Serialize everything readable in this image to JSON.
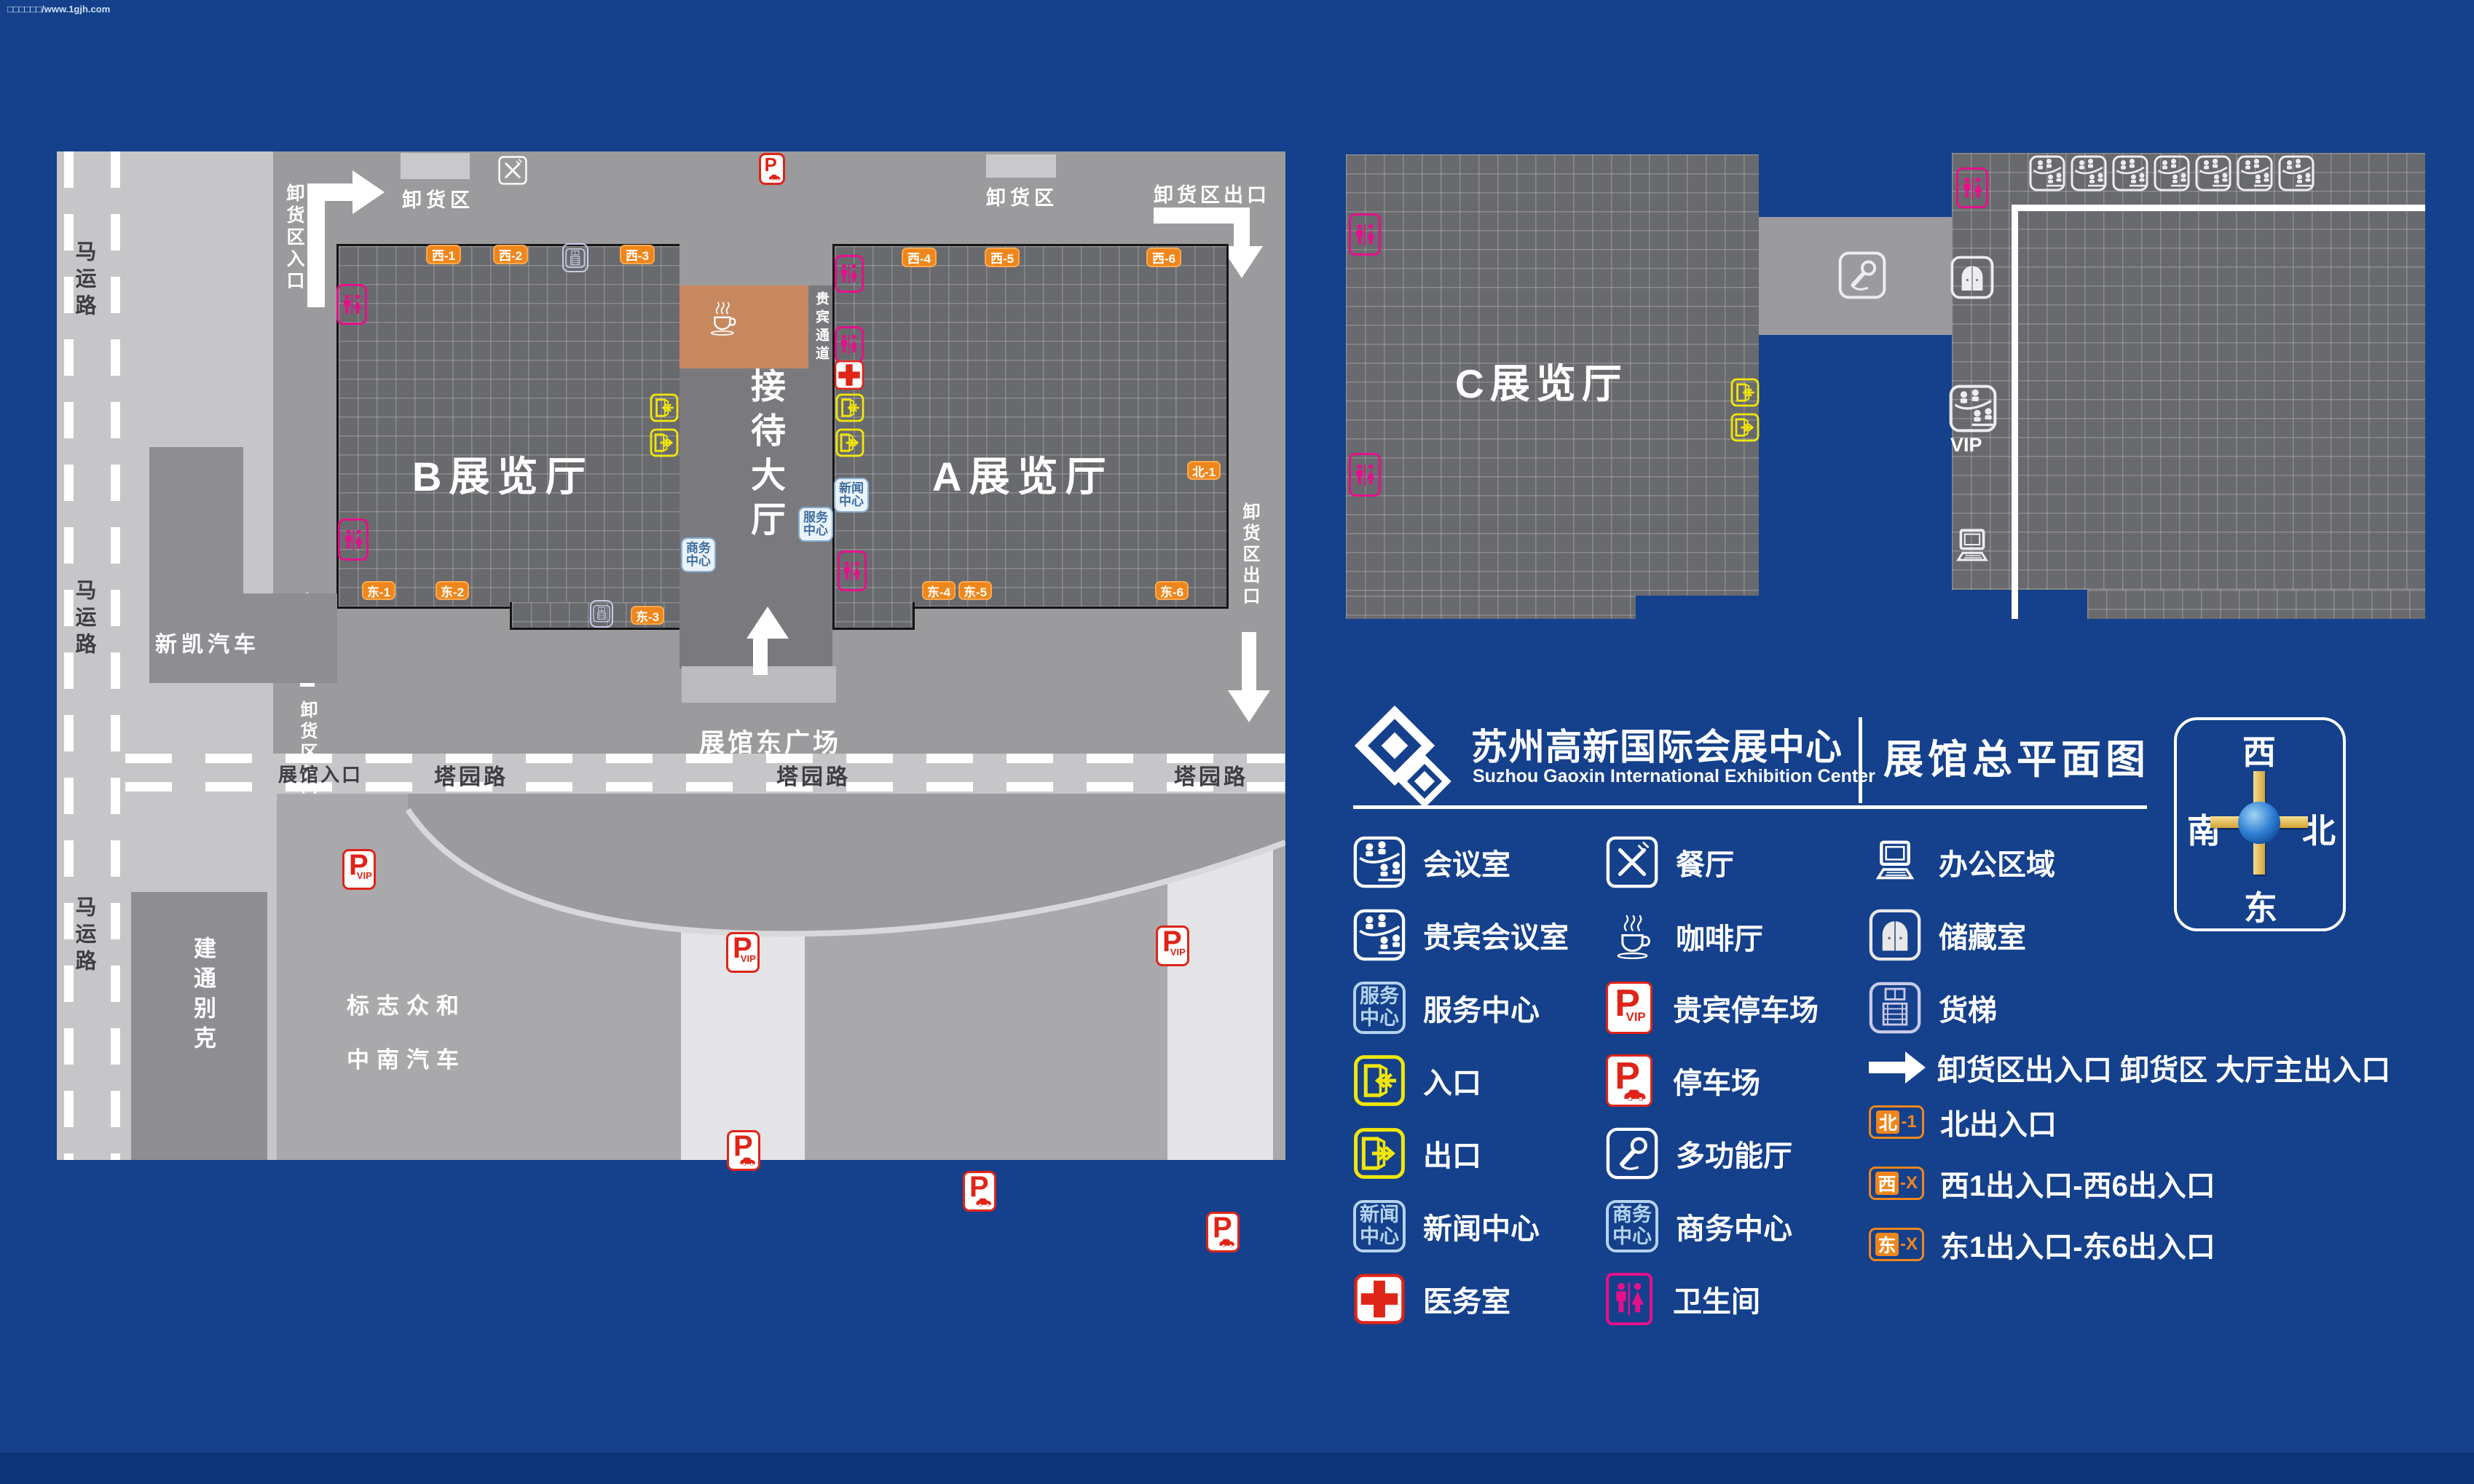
{
  "watermark": "□□□□□□/www.1gjh.com",
  "header": {
    "title_cn": "苏州高新国际会展中心",
    "title_en": "Suzhou Gaoxin International Exhibition Center",
    "map_title": "展馆总平面图"
  },
  "compass": {
    "west": "西",
    "south": "南",
    "north": "北",
    "east": "东"
  },
  "map": {
    "halls": {
      "a": "A展览厅",
      "b": "B展览厅",
      "c": "C展览厅"
    },
    "reception_hall": "接待大厅",
    "vip_passage": "贵宾通道",
    "east_plaza": "展馆东广场",
    "vip_label": "VIP",
    "roads": {
      "mayun": "马运路",
      "tayuan": "塔园路",
      "hall_entrance": "展馆入口"
    },
    "blocks": {
      "xinkai": "新凯汽车",
      "jiantong": "建通别克",
      "biaozhi": "标志众和",
      "zhongnan": "中南汽车"
    },
    "dock": {
      "area": "卸货区",
      "entrance": "卸货区入口",
      "exit": "卸货区出口"
    },
    "badges": {
      "west": [
        "西-1",
        "西-2",
        "西-3",
        "西-4",
        "西-5",
        "西-6"
      ],
      "east": [
        "东-1",
        "东-2",
        "东-3",
        "东-4",
        "东-5",
        "东-6"
      ],
      "north": "北-1"
    },
    "mini": {
      "news": "新闻中心",
      "service": "服务中心",
      "business": "商务中心"
    }
  },
  "icons": {
    "p": "P",
    "vip": "VIP"
  },
  "legend": {
    "col1": [
      {
        "icon": "conference-icon",
        "label": "会议室"
      },
      {
        "icon": "vip-conference-icon",
        "label": "贵宾会议室"
      },
      {
        "icon": "service-center-icon",
        "label": "服务中心"
      },
      {
        "icon": "entrance-icon",
        "label": "入口"
      },
      {
        "icon": "exit-icon",
        "label": "出口"
      },
      {
        "icon": "news-center-icon",
        "label": "新闻中心"
      },
      {
        "icon": "medical-icon",
        "label": "医务室"
      }
    ],
    "col2": [
      {
        "icon": "restaurant-icon",
        "label": "餐厅"
      },
      {
        "icon": "coffee-icon",
        "label": "咖啡厅"
      },
      {
        "icon": "vip-parking-icon",
        "label": "贵宾停车场"
      },
      {
        "icon": "parking-icon",
        "label": "停车场"
      },
      {
        "icon": "multifunction-icon",
        "label": "多功能厅"
      },
      {
        "icon": "business-center-icon",
        "label": "商务中心"
      },
      {
        "icon": "toilet-icon",
        "label": "卫生间"
      }
    ],
    "col3": [
      {
        "icon": "office-icon",
        "label": "办公区域"
      },
      {
        "icon": "storage-icon",
        "label": "储藏室"
      },
      {
        "icon": "freight-elevator-icon",
        "label": "货梯"
      }
    ],
    "special": [
      {
        "icon": "arrow-right-icon",
        "label": "卸货区出入口 卸货区 大厅主出入口"
      },
      {
        "badge_zone": "北",
        "badge_num": "-1",
        "label": "北出入口"
      },
      {
        "badge_zone": "西",
        "badge_num": "-X",
        "label": "西1出入口-西6出入口"
      },
      {
        "badge_zone": "东",
        "badge_num": "-X",
        "label": "东1出入口-东6出入口"
      }
    ]
  },
  "colors": {
    "background_blue": "#14408c",
    "accent_orange": "#ef861b",
    "magenta": "#e6108c",
    "yellow": "#f0e60a",
    "red": "#df2418",
    "lavender": "#c9c9e8",
    "pale_blue": "#b5d3ec"
  }
}
